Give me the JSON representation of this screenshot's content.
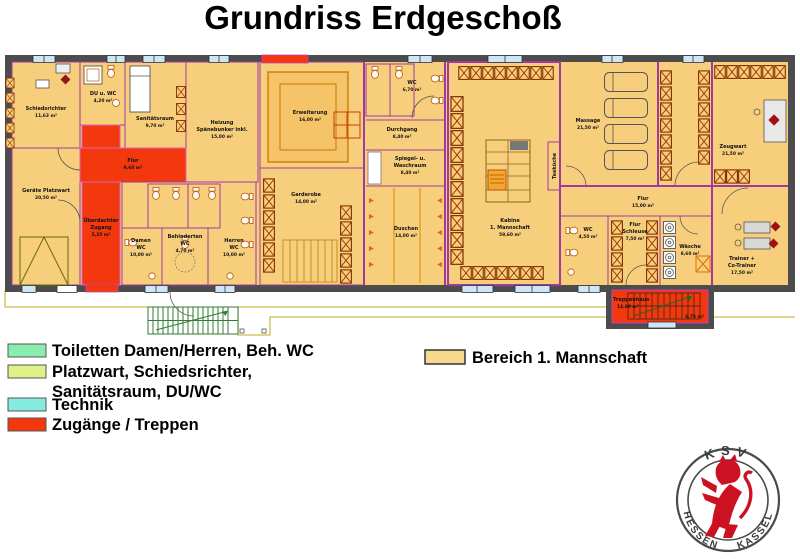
{
  "title": "Grundriss Erdgeschoß",
  "colors": {
    "wall_dark": "#4C4C4C",
    "wall_purple": "#A03AA0",
    "floor_tan": "#F7CE7B",
    "toilet_mint": "#8AEDB0",
    "platzwart_green": "#DFF287",
    "technik_aqua": "#85EBDF",
    "zugang_red": "#F2380C",
    "window_blue": "#CFE6F7",
    "terrace_line": "#CFBE4E",
    "stairs_green": "#2F7D33"
  },
  "legend": {
    "items": [
      {
        "label_line1": "Toiletten Damen/Herren, Beh. WC",
        "label_line2": "",
        "color": "#8AEDB0"
      },
      {
        "label_line1": "Platzwart, Schiedsrichter,",
        "label_line2": "Sanitätsraum, DU/WC",
        "color": "#DFF287"
      },
      {
        "label_line1": "Technik",
        "label_line2": "",
        "color": "#85EBDF"
      },
      {
        "label_line1": "Zugänge / Treppen",
        "label_line2": "",
        "color": "#F2380C"
      }
    ],
    "right_item": {
      "label": "Bereich 1. Mannschaft",
      "color": "#F7D88F"
    }
  },
  "rooms": {
    "schiedsrichter": {
      "name": "Schiedsrichter",
      "area": "11,63 m²"
    },
    "du_wc": {
      "name": "DU u. WC",
      "area": "4,20 m²"
    },
    "sanitaetsraum": {
      "name": "Sanitätsraum",
      "area": "9,70 m²"
    },
    "heizung": {
      "name": "Heizung",
      "name2": "Spänebunker inkl.",
      "area": "15,00 m²"
    },
    "flur_eingang": {
      "name": "Flur",
      "area": "9,60 m²"
    },
    "geraete_platzwart": {
      "name": "Geräte Platzwart",
      "area": "20,50 m²"
    },
    "ueberdachter_zugang": {
      "name": "Überdachter",
      "name2": "Zugang",
      "area": "5,25 m²"
    },
    "damen_wc": {
      "name": "Damen",
      "name2": "WC",
      "area": "10,00 m²"
    },
    "behinderten_wc": {
      "name": "Behinderten",
      "name2": "WC",
      "area": "4,70 m²"
    },
    "herren_wc": {
      "name": "Herren",
      "name2": "WC",
      "area": "10,00 m²"
    },
    "erweiterung": {
      "name": "Erweiterung",
      "area": "16,00 m²"
    },
    "garderobe": {
      "name": "Garderobe",
      "area": "14,00 m²"
    },
    "wc_mitte": {
      "name": "WC",
      "area": "6,70 m²"
    },
    "durchgang": {
      "name": "Durchgang",
      "area": "8,40 m²"
    },
    "spiegel_waschraum": {
      "name": "Spiegel- u.",
      "name2": "Waschraum",
      "area": "8,40 m²"
    },
    "duschen": {
      "name": "Duschen",
      "area": "14,00 m²"
    },
    "kabine": {
      "name": "Kabine",
      "name2": "1. Mannschaft",
      "area": "59,60 m²"
    },
    "teekueche": {
      "name": "Teeküche"
    },
    "massage": {
      "name": "Massage",
      "area": "21,50 m²"
    },
    "zeugwart": {
      "name": "Zeugwart",
      "area": "21,50 m²"
    },
    "flur_rechts": {
      "name": "Flur",
      "area": "15,00 m²"
    },
    "wc_trainer": {
      "name": "WC",
      "area": "4,50 m²"
    },
    "flur_schleuse": {
      "name": "Flur",
      "name2": "Schleuse",
      "area": "7,50 m²"
    },
    "waesche": {
      "name": "Wäsche",
      "area": "8,60 m²"
    },
    "trainer": {
      "name": "Trainer +",
      "name2": "Co-Trainer",
      "area": "17,50 m²"
    },
    "treppenhaus": {
      "name": "Treppenhaus",
      "area": "14,00 m²",
      "area2": "6,75 m²"
    }
  },
  "logo": {
    "top": "KSV",
    "left": "HESSEN",
    "right": "KASSEL",
    "lion_color": "#CC1122"
  }
}
